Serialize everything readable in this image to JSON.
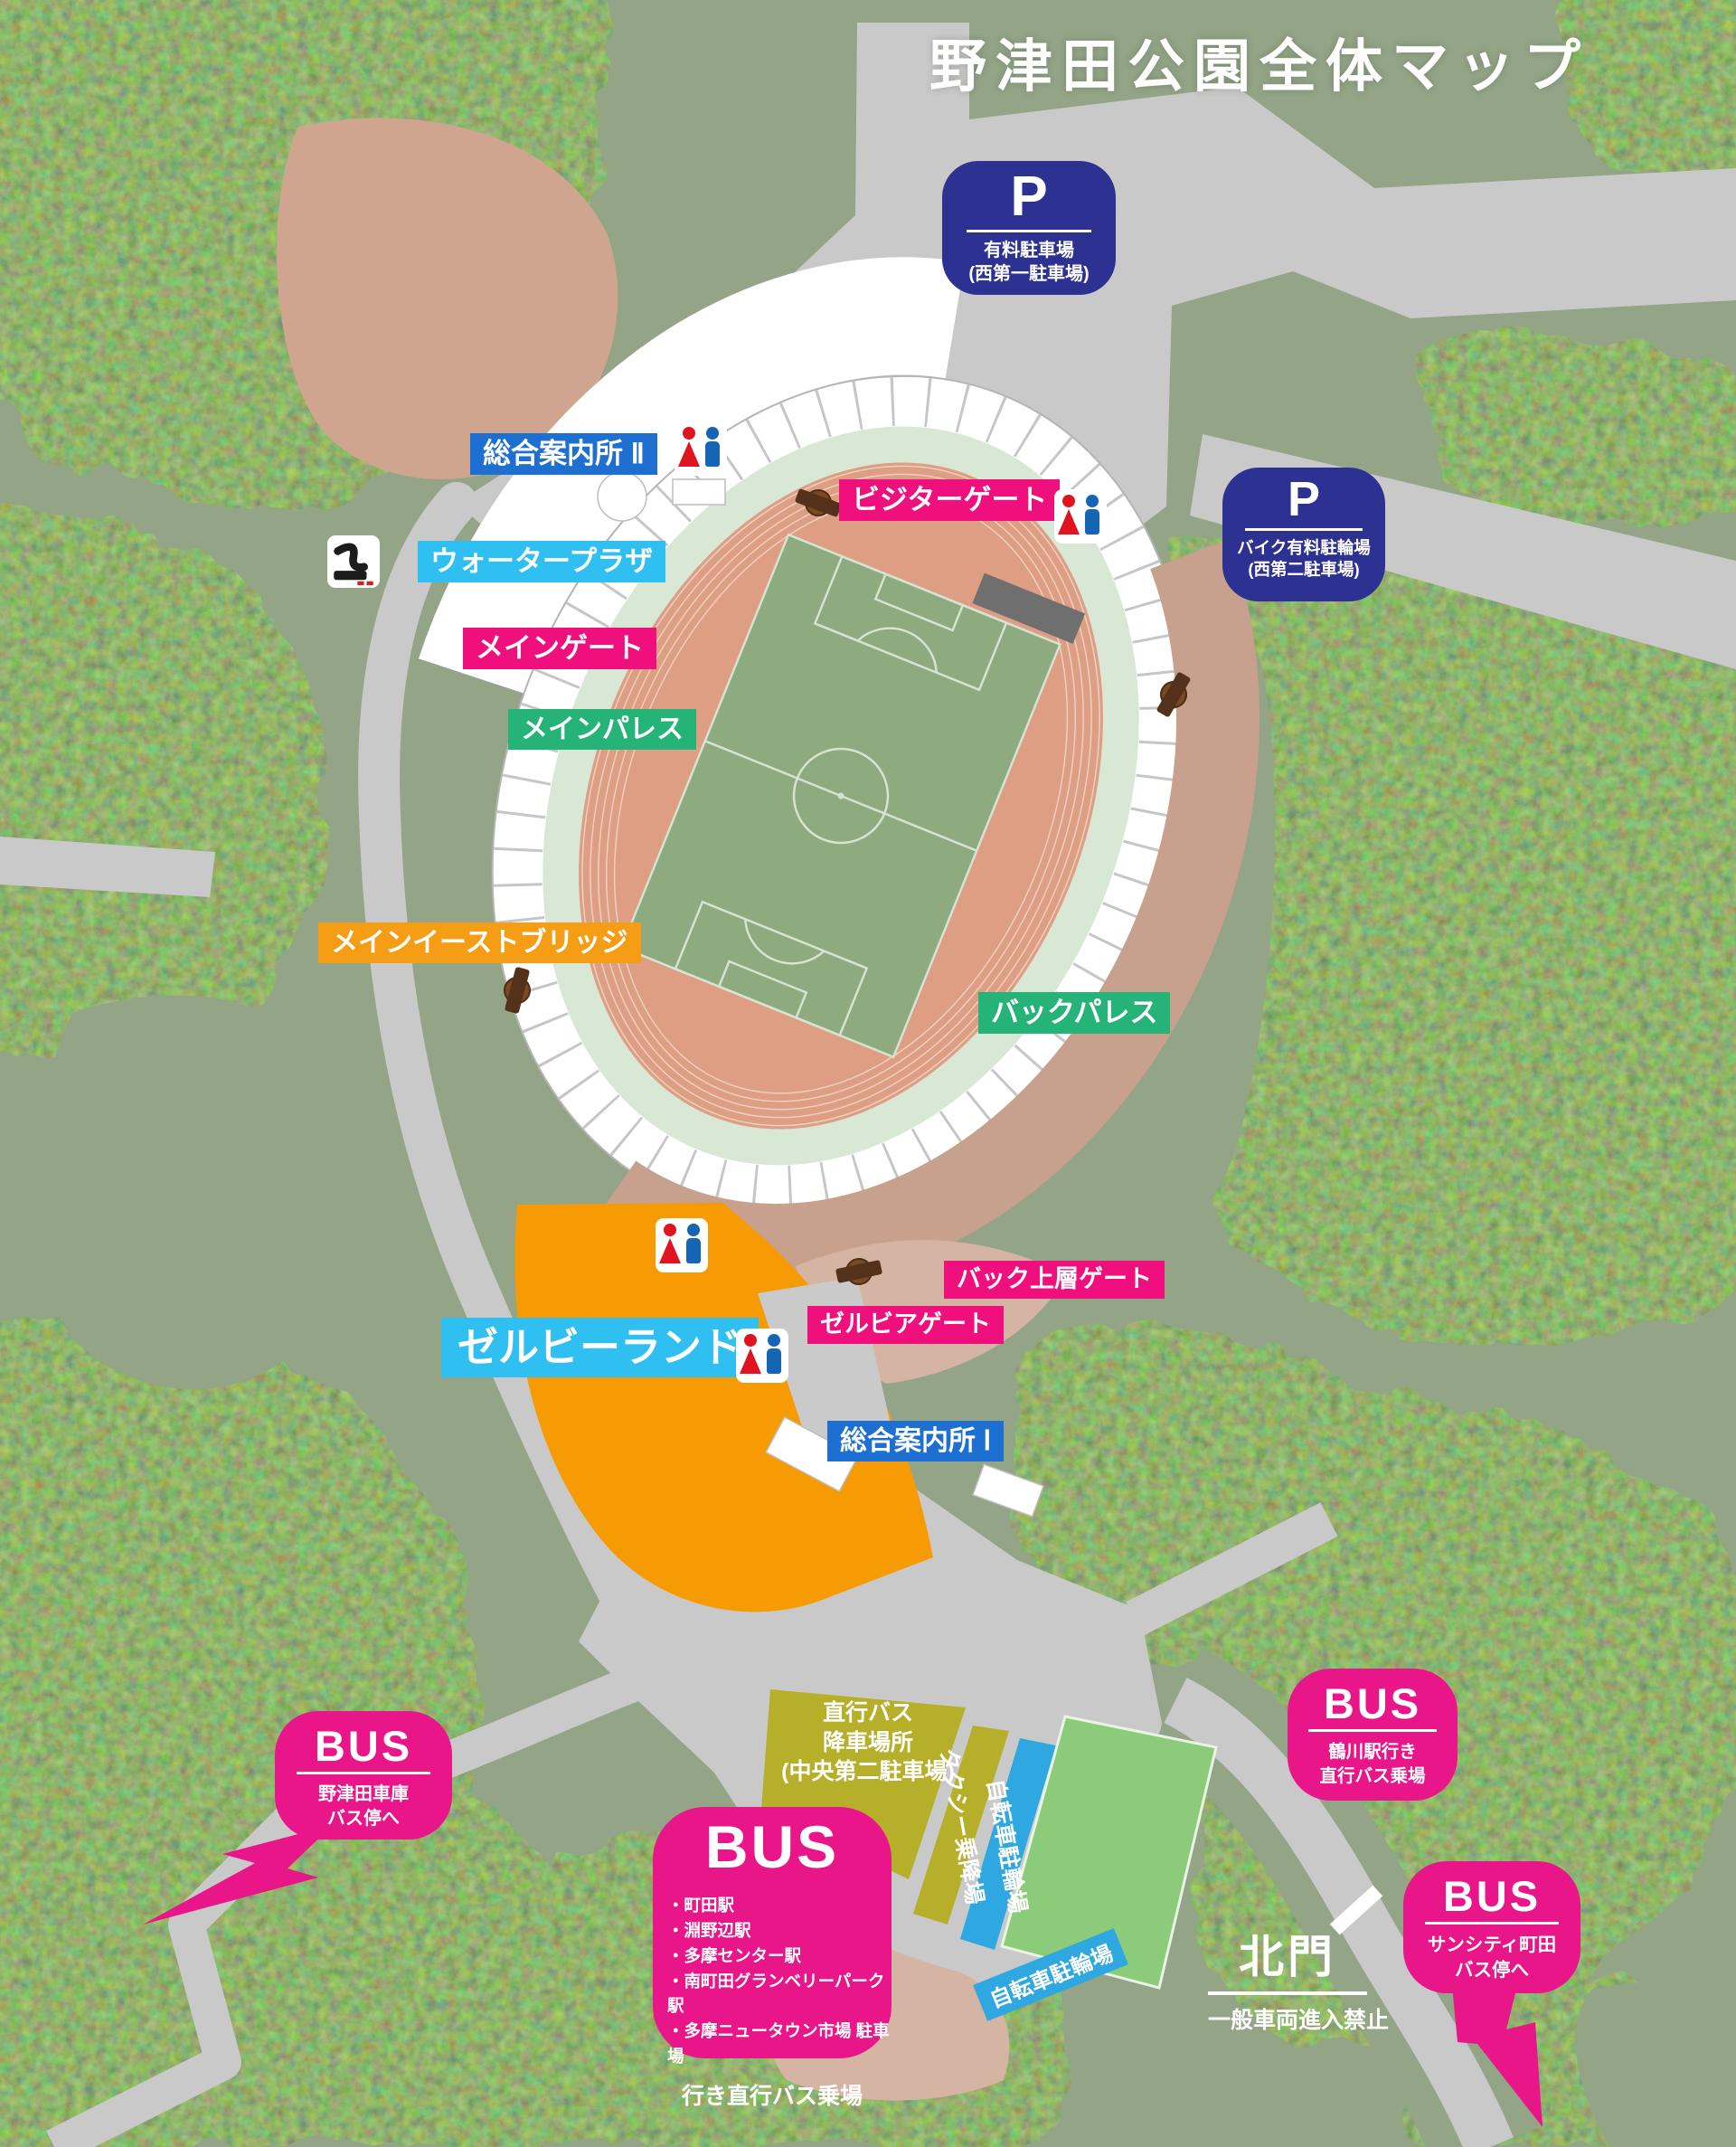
{
  "title": "野津田公園全体マップ",
  "colors": {
    "label_pink": "#f0107d",
    "bus_pink": "#e9168a",
    "label_blue": "#1e6fd2",
    "label_cyan": "#2fc0f1",
    "label_green": "#25b377",
    "label_orange": "#f49d15",
    "parking_navy": "#2c3192",
    "forest_green": "#4a5c26",
    "meadow_green": "#93a487",
    "track_salmon": "#dd9e83",
    "pitch_green": "#8dab7e",
    "road_gray": "#c9c9c9",
    "lot_olive": "#b6af2a",
    "strip_blue": "#2fa7e0",
    "field_green": "#8bcb79"
  },
  "parking_badges": [
    {
      "symbol": "P",
      "lines": [
        "有料駐車場",
        "(西第一駐車場)"
      ]
    },
    {
      "symbol": "P",
      "lines": [
        "バイク有料駐輪場",
        "(西第二駐車場)"
      ]
    }
  ],
  "labels": {
    "info_center_2": "総合案内所 Ⅱ",
    "water_plaza": "ウォータープラザ",
    "visitor_gate": "ビジターゲート",
    "main_gate": "メインゲート",
    "main_palace": "メインパレス",
    "main_east_bridge": "メインイーストブリッジ",
    "back_palace": "バックパレス",
    "back_upper_gate": "バック上層ゲート",
    "zelvia_gate": "ゼルビアゲート",
    "zelvy_land": "ゼルビーランド",
    "info_center_1": "総合案内所 Ⅰ"
  },
  "areas": {
    "chokko_bus_lot_lines": [
      "直行バス",
      "降車場所",
      "(中央第二駐車場)"
    ],
    "taxi_stand": "タクシー乗降場",
    "bicycle_parking_strip": "自転車駐輪場",
    "bicycle_parking_south": "自転車駐輪場"
  },
  "bus_badges": {
    "nozuta_depot": {
      "word": "BUS",
      "lines": [
        "野津田車庫",
        "バス停へ"
      ]
    },
    "tsurukawa": {
      "word": "BUS",
      "lines": [
        "鶴川駅行き",
        "直行バス乗場"
      ]
    },
    "suncity": {
      "word": "BUS",
      "lines": [
        "サンシティ町田",
        "バス停へ"
      ]
    },
    "main_terminal": {
      "word": "BUS",
      "destinations": [
        "町田駅",
        "淵野辺駅",
        "多摩センター駅",
        "南町田グランベリーパーク駅",
        "多摩ニュータウン市場 駐車場"
      ],
      "footer": "行き直行バス乗場"
    }
  },
  "north_gate": {
    "name": "北門",
    "note": "一般車両進入禁止"
  }
}
